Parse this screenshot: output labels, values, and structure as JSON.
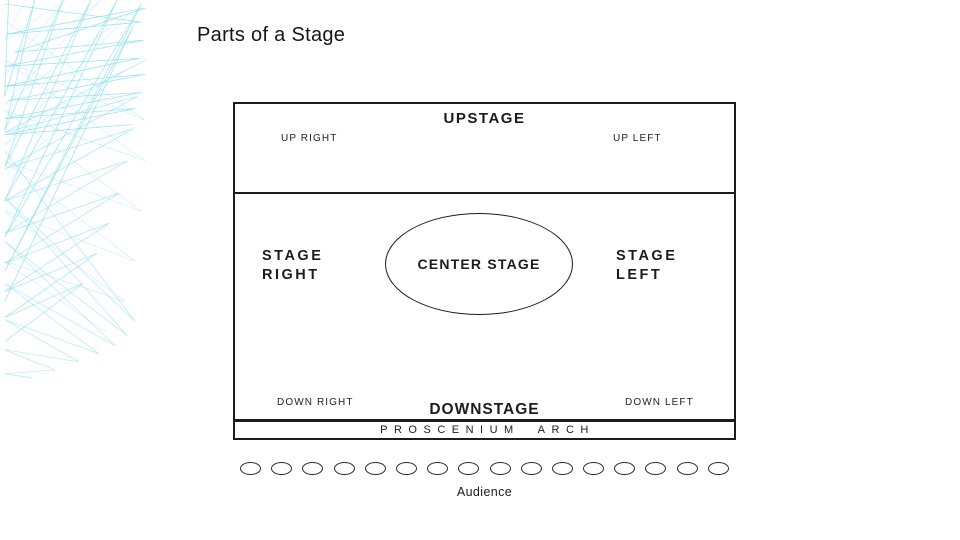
{
  "slide": {
    "title": "Parts of a Stage"
  },
  "stage": {
    "upstage_label": "UPSTAGE",
    "up_right_label": "UP RIGHT",
    "up_left_label": "UP LEFT",
    "stage_right_line1": "STAGE",
    "stage_right_line2": "RIGHT",
    "center_stage_label": "CENTER STAGE",
    "stage_left_line1": "STAGE",
    "stage_left_line2": "LEFT",
    "down_right_label": "DOWN RIGHT",
    "downstage_label": "DOWNSTAGE",
    "down_left_label": "DOWN LEFT",
    "proscenium_label": "PROSCENIUM ARCH"
  },
  "audience": {
    "label": "Audience",
    "seat_count": 16
  },
  "colors": {
    "decor_line": "#8edff0",
    "ink": "#1c1c1c",
    "background": "#ffffff"
  }
}
